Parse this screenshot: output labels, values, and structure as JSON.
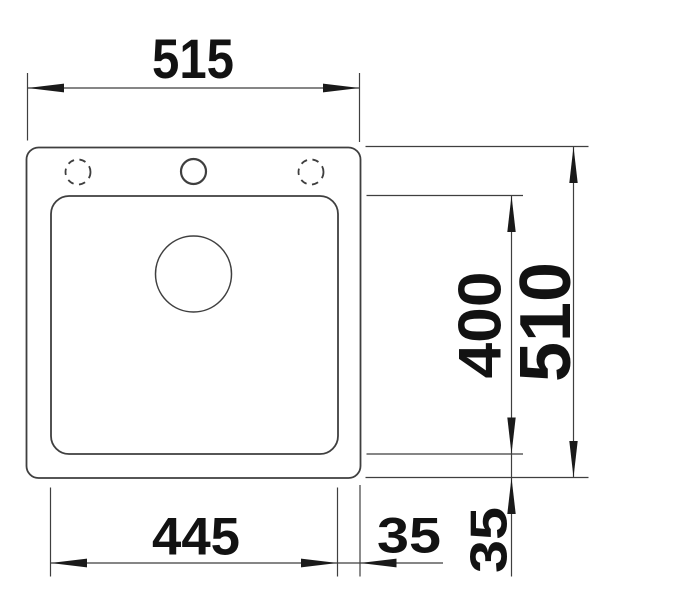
{
  "page": {
    "background_color": "#ffffff",
    "line_color": "#3f3f3f",
    "text_color": "#121212"
  },
  "drawing": {
    "kind": "sink-top-view-dimension-drawing",
    "labels": {
      "overall_width": "515",
      "overall_depth": "510",
      "bowl_width": "445",
      "bowl_depth": "400",
      "bowl_side_offset": "35",
      "bowl_bottom_offset": "35"
    }
  }
}
